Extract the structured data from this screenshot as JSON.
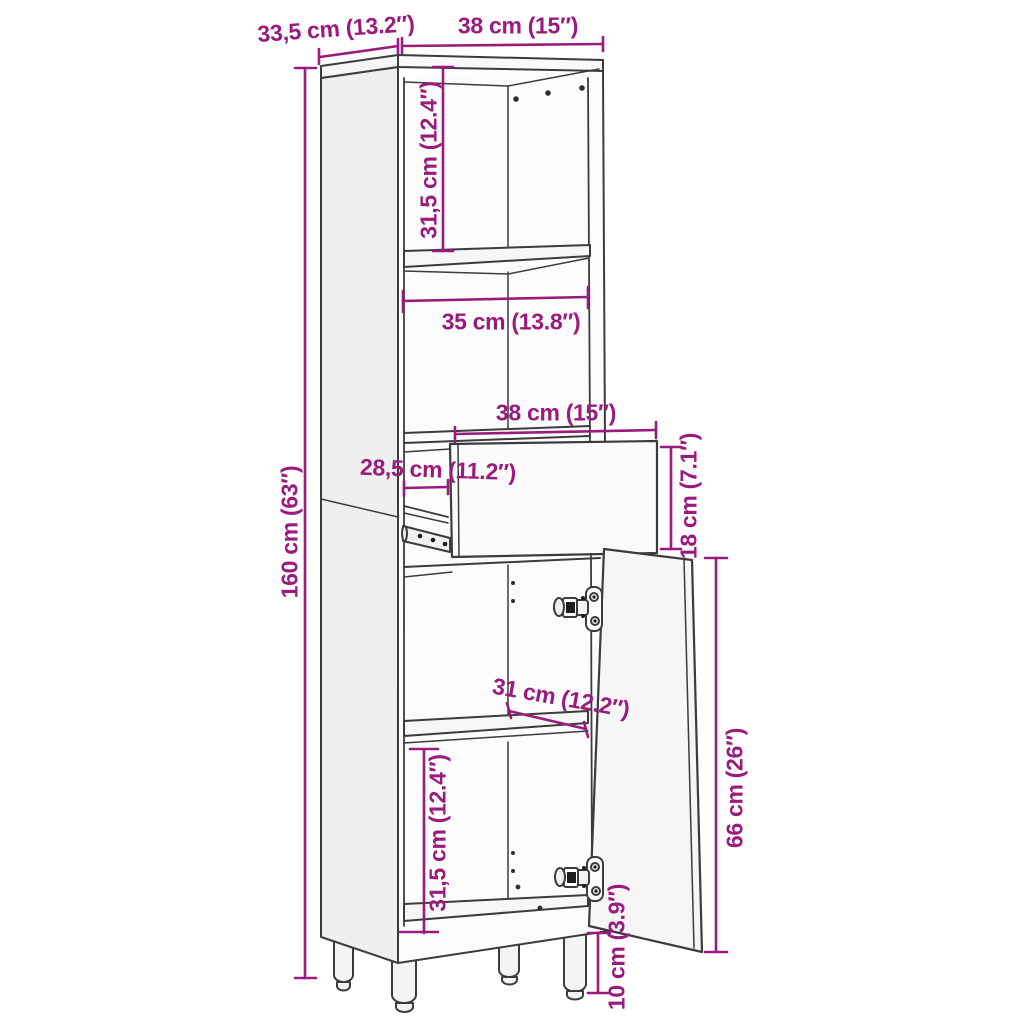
{
  "diagram": {
    "kind": "furniture-dimension-drawing",
    "colors": {
      "dimension_accent": "#9B1A7E",
      "drawing_line": "#3C3C3C",
      "background": "#FFFFFF"
    }
  },
  "labels": {
    "top_depth": "33,5 cm (13.2″)",
    "top_width": "38 cm (15″)",
    "upper_compartment_height": "31,5 cm (12.4″)",
    "middle_compartment_width": "35 cm (13.8″)",
    "drawer_width": "38 cm (15″)",
    "drawer_inner_depth": "28,5 cm (11.2″)",
    "drawer_height": "18 cm (7.1″)",
    "overall_height": "160 cm (63″)",
    "shelf_depth": "31 cm (12.2″)",
    "door_height": "66 cm (26″)",
    "lower_compartment_height": "31,5 cm (12.4″)",
    "leg_height": "10 cm (3.9″)"
  }
}
